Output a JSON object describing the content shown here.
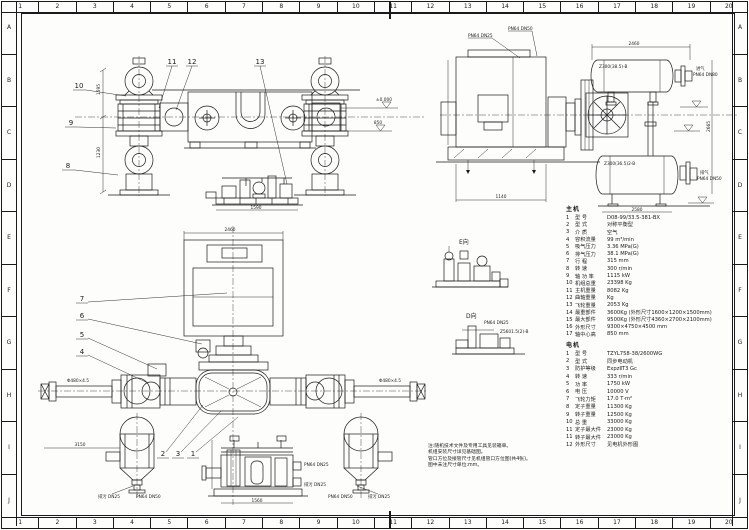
{
  "sheet": {
    "bg": "#fdfdfc",
    "ink": "#1a1a1a"
  },
  "grid": {
    "columns": [
      "1",
      "2",
      "3",
      "4",
      "5",
      "6",
      "7",
      "8",
      "9",
      "10",
      "11",
      "12",
      "13",
      "14",
      "15",
      "16",
      "17",
      "18",
      "19",
      "20"
    ],
    "rows": [
      "A",
      "B",
      "C",
      "D",
      "E",
      "F",
      "G",
      "H",
      "I",
      "J"
    ]
  },
  "specs_main": {
    "title": "主机",
    "items": [
      {
        "n": "1",
        "label": "型 号",
        "value": "D08-99/33.5-381-BX"
      },
      {
        "n": "2",
        "label": "型 式",
        "value": "对称平衡型"
      },
      {
        "n": "3",
        "label": "介 质",
        "value": "空气"
      },
      {
        "n": "4",
        "label": "容积流量",
        "value": "99 m³/min"
      },
      {
        "n": "5",
        "label": "吸气压力",
        "value": "3.36 MPa(G)"
      },
      {
        "n": "6",
        "label": "排气压力",
        "value": "38.1 MPa(G)"
      },
      {
        "n": "7",
        "label": "行 程",
        "value": "315 mm"
      },
      {
        "n": "8",
        "label": "转 速",
        "value": "300 r/min"
      },
      {
        "n": "9",
        "label": "轴 功 率",
        "value": "1115 kW"
      },
      {
        "n": "10",
        "label": "机组总重",
        "value": "23398 Kg"
      },
      {
        "n": "11",
        "label": "主机重量",
        "value": "8082 Kg"
      },
      {
        "n": "12",
        "label": "曲轴重量",
        "value": "Kg"
      },
      {
        "n": "13",
        "label": "飞轮重量",
        "value": "2053 Kg"
      },
      {
        "n": "14",
        "label": "最重部件",
        "value": "3600Kg (外形尺寸1600×1200×1500mm)"
      },
      {
        "n": "15",
        "label": "最大部件",
        "value": "9500Kg (外形尺寸4360×2700×2100mm)"
      },
      {
        "n": "16",
        "label": "外形尺寸",
        "value": "9300×4750×4500 mm"
      },
      {
        "n": "17",
        "label": "轴中心高",
        "value": "850 mm"
      }
    ]
  },
  "specs_motor": {
    "title": "电机",
    "items": [
      {
        "n": "1",
        "label": "型 号",
        "value": "TZYL758-38/2600WG"
      },
      {
        "n": "2",
        "label": "型 式",
        "value": "同步电动机"
      },
      {
        "n": "3",
        "label": "防护等级",
        "value": "ExpzⅡT3 Gc"
      },
      {
        "n": "4",
        "label": "转 速",
        "value": "333 r/min"
      },
      {
        "n": "5",
        "label": "功 率",
        "value": "1750 kW"
      },
      {
        "n": "6",
        "label": "电 压",
        "value": "10000 V"
      },
      {
        "n": "7",
        "label": "飞轮力矩",
        "value": "17.0 T·m²"
      },
      {
        "n": "8",
        "label": "定子重量",
        "value": "11300 Kg"
      },
      {
        "n": "9",
        "label": "转子重量",
        "value": "12500 Kg"
      },
      {
        "n": "10",
        "label": "总 重",
        "value": "33000 Kg"
      },
      {
        "n": "11",
        "label": "定子最大件",
        "value": "23000 Kg"
      },
      {
        "n": "11",
        "label": "转子最大件",
        "value": "23000 Kg"
      },
      {
        "n": "12",
        "label": "外形尺寸",
        "value": "见电机外形图"
      }
    ]
  },
  "notes": {
    "lines": [
      "注:随机技术文件及专用工具见装箱单。",
      "机组安装尺寸详见基础图。",
      "管口方位及接管尺寸见机组管口方位图(共4张)。",
      "图中未注尺寸单位:mm。"
    ]
  },
  "balloons": {
    "front": [
      "10",
      "9",
      "8",
      "11",
      "12",
      "13"
    ],
    "plan": [
      "7",
      "6",
      "5",
      "4",
      "2",
      "3",
      "1"
    ]
  },
  "annotations": {
    "front": {
      "dim_upper": "1595",
      "dim_lower": "1230",
      "level_top": "±0.000",
      "level_mid": "850"
    },
    "aux_top": {
      "dim": "1590"
    },
    "side": {
      "tag_top_vessel": "Z300(38.5)-B",
      "tag_bottom_vessel": "Z300(36.5)2-B",
      "inlet_line1": "进气",
      "inlet_line2": "PN64 DN80",
      "outlet_line1": "排气",
      "outlet_line2": "PN64 DN50",
      "relief_a": "PN64 DN25",
      "relief_b": "PN64 DN50",
      "dim_vessels": "2460",
      "dim_motor": "1140",
      "dim_height": "2665",
      "dim_bottom": "2580"
    },
    "plan": {
      "dim_motor": "2460",
      "dim_left": "3150",
      "pipe_left": "Φ480×4.5",
      "pipe_right": "Φ480×4.5",
      "left_vessel_drain": "排污 DN25",
      "left_vessel_conn": "PN64 DN50",
      "right_vessel_conn": "PN64 DN50",
      "right_vessel_drain": "排污 DN25"
    },
    "detail_e": {
      "label": "E向"
    },
    "detail_d": {
      "label": "D向",
      "conn": "PN64 DN25",
      "tag": "Z5601.5(2)-B"
    },
    "aux_bottom": {
      "conn": "PN64 DN25",
      "drain": "排污 DN25",
      "dim": "1560"
    }
  }
}
